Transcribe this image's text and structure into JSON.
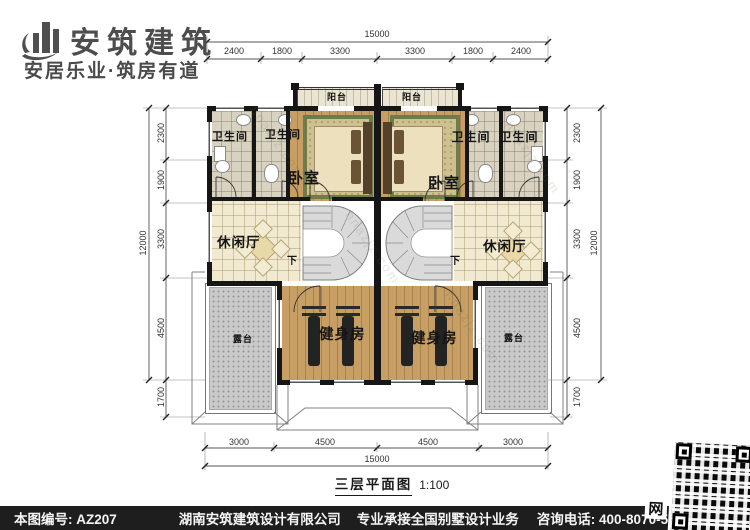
{
  "branding": {
    "name": "安筑建筑",
    "tagline": "安居乐业·筑房有道"
  },
  "plan": {
    "title": "三层平面图",
    "scale": "1:100",
    "rooms": {
      "balcony_left": "阳台",
      "balcony_right": "阳台",
      "bath_outer_left": "卫生间",
      "bath_inner_left": "卫生间",
      "bath_inner_right": "卫生间",
      "bath_outer_right": "卫生间",
      "bedroom_left": "卧室",
      "bedroom_right": "卧室",
      "lounge_left": "休闲厅",
      "lounge_right": "休闲厅",
      "gym_left": "健身房",
      "gym_right": "健身房",
      "terrace_left": "露台",
      "terrace_right": "露台",
      "stairs_down_left": "下",
      "stairs_down_right": "下"
    }
  },
  "dims": {
    "top_total": "15000",
    "top_segments": [
      "2400",
      "1800",
      "3300",
      "3300",
      "1800",
      "2400"
    ],
    "bottom_segments": [
      "3000",
      "4500",
      "4500",
      "3000"
    ],
    "bottom_total": "15000",
    "left_segments": [
      "2300",
      "1900",
      "3300",
      "4500",
      "1700"
    ],
    "left_total": "12000",
    "right_segments": [
      "2300",
      "1900",
      "3300",
      "4500",
      "1700"
    ],
    "right_total": "12000"
  },
  "footer": {
    "drawing_no": "本图编号: AZ207",
    "company": "湖南安筑建筑设计有限公司",
    "slogan": "专业承接全国别墅设计业务",
    "phone": "咨询电话: 400-8070-511",
    "web_badge": "网"
  },
  "watermark": "hnazjz.com"
}
